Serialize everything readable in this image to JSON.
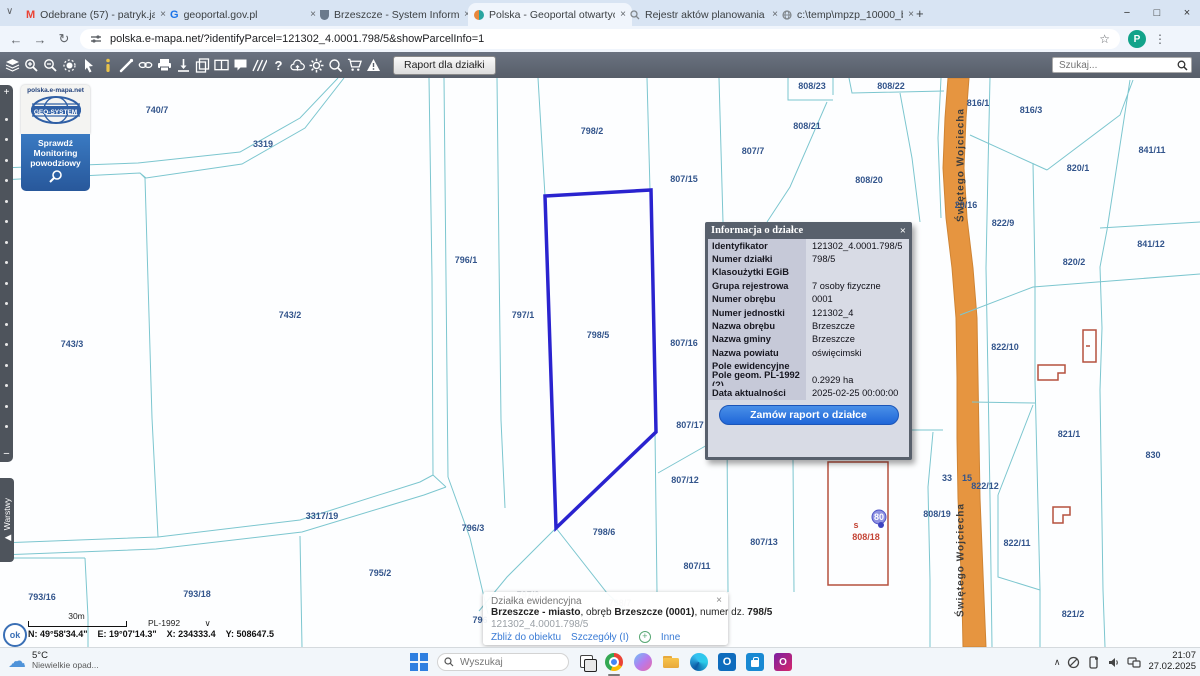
{
  "browser": {
    "tabs": [
      {
        "label": "Odebrane (57) - patryk.jakubow",
        "icon": "gmail-icon"
      },
      {
        "label": "geoportal.gov.pl",
        "icon": "geoportal-icon"
      },
      {
        "label": "Brzeszcze - System Informacji P",
        "icon": "brzeszcze-crest-icon"
      },
      {
        "label": "Polska - Geoportal otwartych d",
        "icon": "polska-geoportal-icon",
        "active": true
      },
      {
        "label": "Rejestr aktów planowania prze",
        "icon": "rejestr-icon"
      },
      {
        "label": "c:\\temp\\mpzp_10000_bardzo_d",
        "icon": "file-globe-icon"
      }
    ],
    "url": "polska.e-mapa.net/?identifyParcel=121302_4.0001.798/5&showParcelInfo=1",
    "profile_initial": "P"
  },
  "map_toolbar": {
    "report_button": "Raport dla działki",
    "search_placeholder": "Szukaj...",
    "icons": [
      "layers",
      "zoom-in",
      "zoom-out",
      "select-area",
      "pointer",
      "info",
      "measure",
      "link",
      "print",
      "locate",
      "copy-map",
      "split-view",
      "comment",
      "hatch-slope",
      "help",
      "cloud-upload",
      "settings",
      "magnifier-plus",
      "cart",
      "warning"
    ]
  },
  "sidebar": {
    "logo_domain": "polska.e-mapa.net",
    "logo_brand": "GEO-SYSTEM",
    "monitoring_button_line1": "Sprawdź",
    "monitoring_button_line2": "Monitoring",
    "monitoring_button_line3": "powodziowy",
    "layers_tab": "Warstwy"
  },
  "map": {
    "labels": [
      {
        "t": "740/7",
        "x": 157,
        "y": 32
      },
      {
        "t": "3319",
        "x": 263,
        "y": 66
      },
      {
        "t": "798/2",
        "x": 592,
        "y": 53
      },
      {
        "t": "807/15",
        "x": 684,
        "y": 101
      },
      {
        "t": "807/7",
        "x": 753,
        "y": 73
      },
      {
        "t": "808/23",
        "x": 812,
        "y": 8
      },
      {
        "t": "808/22",
        "x": 891,
        "y": 8
      },
      {
        "t": "808/21",
        "x": 807,
        "y": 48
      },
      {
        "t": "808/20",
        "x": 869,
        "y": 102
      },
      {
        "t": "816/1",
        "x": 978,
        "y": 25
      },
      {
        "t": "816/3",
        "x": 1031,
        "y": 32
      },
      {
        "t": "841/11",
        "x": 1152,
        "y": 72
      },
      {
        "t": "820/1",
        "x": 1078,
        "y": 90
      },
      {
        "t": "20/16",
        "x": 966,
        "y": 127
      },
      {
        "t": "822/9",
        "x": 1003,
        "y": 145
      },
      {
        "t": "841/12",
        "x": 1151,
        "y": 166
      },
      {
        "t": "820/2",
        "x": 1074,
        "y": 184
      },
      {
        "t": "822/10",
        "x": 1005,
        "y": 269
      },
      {
        "t": "796/1",
        "x": 466,
        "y": 182
      },
      {
        "t": "797/1",
        "x": 523,
        "y": 237
      },
      {
        "t": "798/5",
        "x": 598,
        "y": 257
      },
      {
        "t": "743/2",
        "x": 290,
        "y": 237
      },
      {
        "t": "743/3",
        "x": 72,
        "y": 266
      },
      {
        "t": "807/16",
        "x": 684,
        "y": 265
      },
      {
        "t": "807/17",
        "x": 690,
        "y": 347
      },
      {
        "t": "807/12",
        "x": 685,
        "y": 402
      },
      {
        "t": "3317/19",
        "x": 322,
        "y": 438
      },
      {
        "t": "796/3",
        "x": 473,
        "y": 450
      },
      {
        "t": "798/6",
        "x": 604,
        "y": 454
      },
      {
        "t": "807/13",
        "x": 764,
        "y": 464
      },
      {
        "t": "807/11",
        "x": 697,
        "y": 488
      },
      {
        "t": "795/2",
        "x": 380,
        "y": 495
      },
      {
        "t": "793/16",
        "x": 42,
        "y": 519
      },
      {
        "t": "793/18",
        "x": 197,
        "y": 516
      },
      {
        "t": "821/1",
        "x": 1069,
        "y": 356
      },
      {
        "t": "830",
        "x": 1153,
        "y": 377
      },
      {
        "t": "822/12",
        "x": 985,
        "y": 408
      },
      {
        "t": "33",
        "x": 947,
        "y": 400
      },
      {
        "t": "15",
        "x": 967,
        "y": 400
      },
      {
        "t": "808/19",
        "x": 937,
        "y": 436
      },
      {
        "t": "822/11",
        "x": 1017,
        "y": 465
      },
      {
        "t": "821/2",
        "x": 1073,
        "y": 536
      },
      {
        "t": "796",
        "x": 480,
        "y": 542
      },
      {
        "t": "797/2",
        "x": 528,
        "y": 517,
        "c": "#aab0ba"
      },
      {
        "t": "798/7",
        "x": 620,
        "y": 525,
        "c": "#aab0ba"
      },
      {
        "t": "s",
        "x": 856,
        "y": 447,
        "c": "#c44536"
      },
      {
        "t": "808/18",
        "x": 866,
        "y": 459,
        "c": "#c44536"
      },
      {
        "t": "80",
        "x": 879,
        "y": 439,
        "c": "#ffffff"
      },
      {
        "t": "Świętego Wojciecha",
        "x": 961,
        "y": 87,
        "r": -90,
        "c": "#3d3d3d",
        "street": true
      },
      {
        "t": "Świętego Wojciecha",
        "x": 961,
        "y": 482,
        "r": -90,
        "c": "#3d3d3d",
        "street": true
      }
    ]
  },
  "parcel_info": {
    "title": "Informacja o działce",
    "rows": [
      {
        "label": "Identyfikator",
        "value": "121302_4.0001.798/5"
      },
      {
        "label": "Numer działki",
        "value": "798/5"
      },
      {
        "label": "Klasoużytki EGiB",
        "value": ""
      },
      {
        "label": "Grupa rejestrowa",
        "value": "7 osoby fizyczne"
      },
      {
        "label": "Numer obrębu",
        "value": "0001"
      },
      {
        "label": "Numer jednostki",
        "value": "121302_4"
      },
      {
        "label": "Nazwa obrębu",
        "value": "Brzeszcze"
      },
      {
        "label": "Nazwa gminy",
        "value": "Brzeszcze"
      },
      {
        "label": "Nazwa powiatu",
        "value": "oświęcimski"
      },
      {
        "label": "Pole ewidencyjne",
        "value": ""
      },
      {
        "label": "Pole geom. PL-1992 (?)",
        "value": "0.2929 ha"
      },
      {
        "label": "Data aktualności",
        "value": "2025-02-25 00:00:00"
      }
    ],
    "order_button": "Zamów raport o działce"
  },
  "feature_popup": {
    "title": "Działka ewidencyjna",
    "name_bold1": "Brzeszcze - miasto",
    "name_mid1": ", obręb ",
    "name_bold2": "Brzeszcze (0001)",
    "name_mid2": ", numer dz. ",
    "name_bold3": "798/5",
    "id": "121302_4.0001.798/5",
    "links": {
      "zoom": "Zbliż do obiektu",
      "details": "Szczegóły (I)",
      "other": "Inne"
    }
  },
  "status_bar": {
    "scale_label": "30m",
    "crs": "PL-1992",
    "coord_n": "N: 49°58'34.4\"",
    "coord_e": "E: 19°07'14.3\"",
    "coord_x": "X: 234333.4",
    "coord_y": "Y: 508647.5"
  },
  "taskbar": {
    "temperature": "5°C",
    "weather": "Niewielkie opad...",
    "search_placeholder": "Wyszukaj",
    "time": "21:07",
    "date": "27.02.2025"
  }
}
